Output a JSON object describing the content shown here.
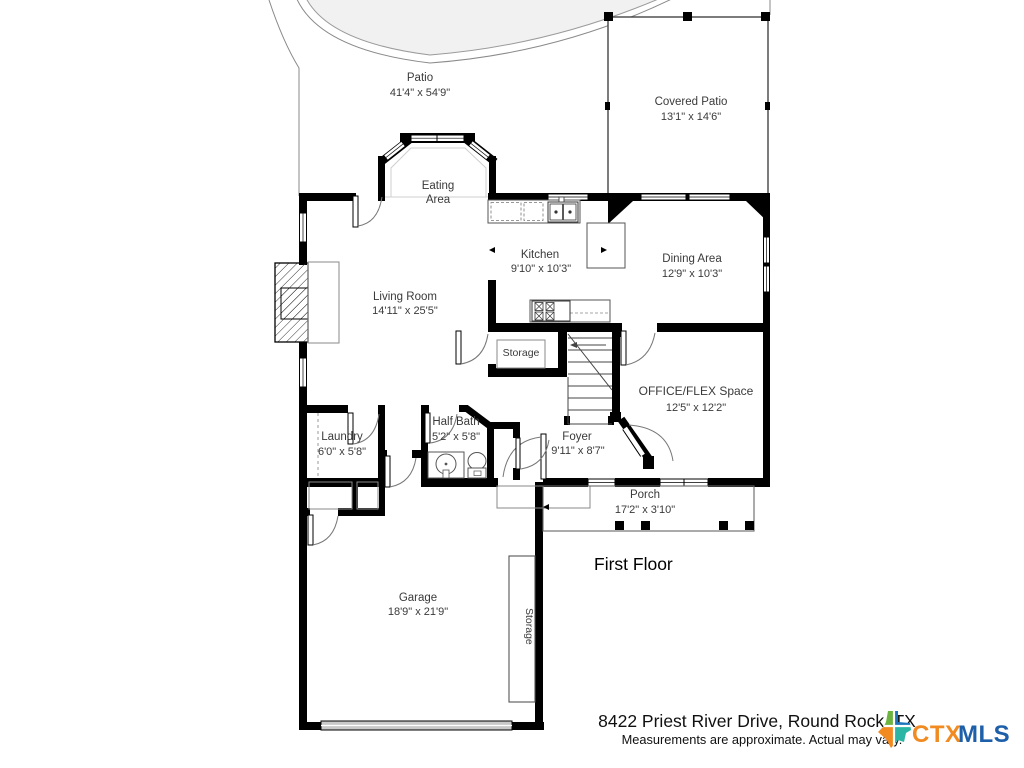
{
  "title": "First Floor",
  "footer": {
    "address": "8422 Priest River Drive, Round Rock, TX",
    "disclaimer": "Measurements are approximate.  Actual may vary."
  },
  "logo": {
    "ctx": "CTX",
    "mls": "MLS",
    "ctx_color": "#F08A21",
    "mls_color": "#1E5FA9",
    "texas": {
      "top_left": "#6CB33F",
      "top_right": "#1C75BC",
      "bottom_left": "#F08A21",
      "bottom_right": "#2BB5A5"
    }
  },
  "rooms": {
    "patio": {
      "name": "Patio",
      "dims": "41'4\" x 54'9\""
    },
    "covered_patio": {
      "name": "Covered Patio",
      "dims": "13'1\" x 14'6\""
    },
    "eating_area": {
      "line1": "Eating",
      "line2": "Area"
    },
    "kitchen": {
      "name": "Kitchen",
      "dims": "9'10\" x 10'3\""
    },
    "dining_area": {
      "name": "Dining Area",
      "dims": "12'9\" x 10'3\""
    },
    "living_room": {
      "name": "Living Room",
      "dims": "14'11\" x 25'5\""
    },
    "storage_closet": {
      "name": "Storage"
    },
    "office_flex": {
      "name": "OFFICE/FLEX Space",
      "dims": "12'5\" x 12'2\""
    },
    "half_bath": {
      "name": "Half Bath",
      "dims": "5'2\" x 5'8\""
    },
    "laundry": {
      "name": "Laundry",
      "dims": "6'0\" x 5'8\""
    },
    "foyer": {
      "name": "Foyer",
      "dims": "9'11\" x 8'7\""
    },
    "porch": {
      "name": "Porch",
      "dims": "17'2\" x 3'10\""
    },
    "garage": {
      "name": "Garage",
      "dims": "18'9\" x 21'9\""
    },
    "garage_storage": {
      "name": "Storage"
    }
  }
}
